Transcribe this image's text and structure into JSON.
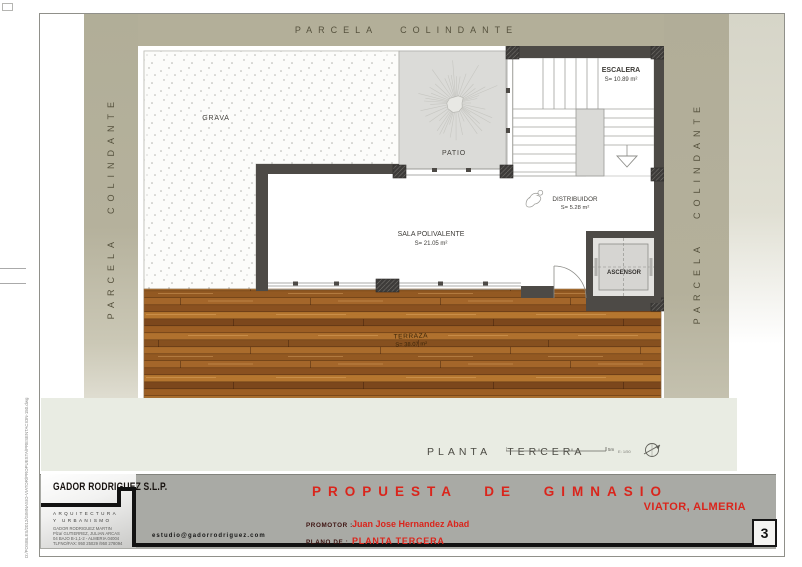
{
  "site": {
    "top": "PARCELA COLINDANTE",
    "left": "PARCELA COLINDANTE",
    "right": "PARCELA COLINDANTE"
  },
  "plan": {
    "grava": "GRAVA",
    "patio": "PATIO",
    "escalera_name": "ESCALERA",
    "escalera_area": "S= 10.89 m²",
    "distribuidor_name": "DISTRIBUIDOR",
    "distribuidor_area": "S= 5.28 m²",
    "sala_name": "SALA POLIVALENTE",
    "sala_area": "S= 21.05 m²",
    "ascensor": "ASCENSOR",
    "terraza_name": "TERRAZA",
    "terraza_area": "S= 38.07 m²"
  },
  "footer": {
    "plan_title": "PLANTA TERCERA",
    "scale_units": "5m",
    "scale_ratio": "E: 1/50"
  },
  "title_block": {
    "firm": "GADOR RODRIGUEZ S.L.P.",
    "tagline1": "ARQUITECTURA",
    "tagline2": "Y URBANISMO",
    "address1": "GADOR RODRIGUEZ MARTIN",
    "address2": "Plza/ GUTIERREZ, JULIAN ARCAS",
    "address3": "04 BAJO B-1,1-2 - ALMERIA 04004",
    "address4": "TLFNO/FAX: 950 25029 /950 278094",
    "email": "estudio@gadorrodriguez.com",
    "project": "PROPUESTA DE GIMNASIO",
    "location": "VIATOR, ALMERIA",
    "promotor_label": "PROMOTOR :",
    "promotor": "Juan Jose Hernandez Abad",
    "plano_label": "PLANO DE :",
    "plano": "PLANTA TERCERA",
    "sheet": "3"
  },
  "margin_note": "D:/POSIBLES/2012/GIMNASIO-VIATOR/PROPUESTA/PRESENTACION-150.dwg",
  "colors": {
    "accent_red": "#da251c",
    "band_olive": "#b2ae99",
    "wall": "#4d4a46",
    "wood": "#a96b2d"
  }
}
